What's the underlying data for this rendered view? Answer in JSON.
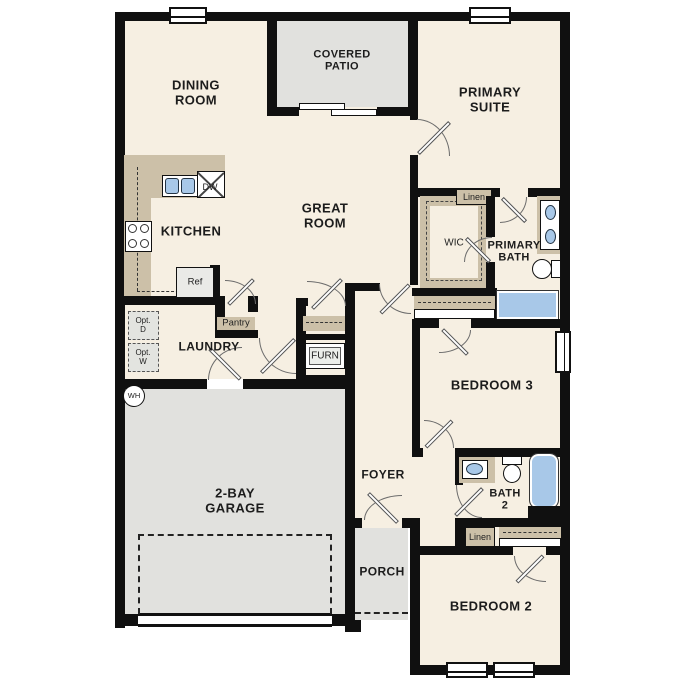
{
  "floorplan": {
    "rooms": {
      "dining": {
        "l1": "DINING",
        "l2": "ROOM"
      },
      "covered_patio": {
        "l1": "COVERED",
        "l2": "PATIO"
      },
      "primary_suite": {
        "l1": "PRIMARY",
        "l2": "SUITE"
      },
      "kitchen": {
        "l1": "KITCHEN"
      },
      "great_room": {
        "l1": "GREAT",
        "l2": "ROOM"
      },
      "wic": {
        "l1": "WIC"
      },
      "primary_bath": {
        "l1": "PRIMARY",
        "l2": "BATH"
      },
      "laundry": {
        "l1": "LAUNDRY"
      },
      "bedroom3": {
        "l1": "BEDROOM 3"
      },
      "foyer": {
        "l1": "FOYER"
      },
      "bath2": {
        "l1": "BATH",
        "l2": "2"
      },
      "garage": {
        "l1": "2-BAY",
        "l2": "GARAGE"
      },
      "porch": {
        "l1": "PORCH"
      },
      "bedroom2": {
        "l1": "BEDROOM 2"
      }
    },
    "fixtures": {
      "linen_upper": "Linen",
      "linen_lower": "Linen",
      "pantry": "Pantry",
      "furnace": "FURN",
      "refrigerator": "Ref",
      "dishwasher": "DW",
      "water_heater": "WH",
      "opt_dryer": {
        "l1": "Opt.",
        "l2": "D"
      },
      "opt_washer": {
        "l1": "Opt.",
        "l2": "W"
      }
    },
    "colors": {
      "wall": "#101010",
      "floor": "#f6efe2",
      "outdoor": "#e1e1de",
      "casework": "#ccc0a8",
      "plumbing": "#a8c8e8",
      "appliance": "#eaeae7"
    }
  }
}
